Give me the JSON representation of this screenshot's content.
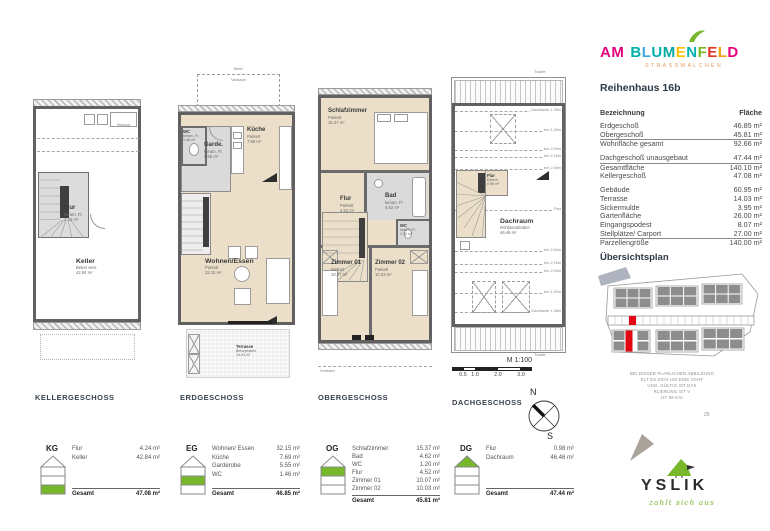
{
  "logo": {
    "letters": [
      {
        "ch": "A",
        "c": "#e5007d"
      },
      {
        "ch": "M",
        "c": "#e5007d"
      },
      {
        "ch": "B",
        "c": "#00b1af"
      },
      {
        "ch": "L",
        "c": "#3fa9dc"
      },
      {
        "ch": "U",
        "c": "#00b1af"
      },
      {
        "ch": "M",
        "c": "#00a99d"
      },
      {
        "ch": "E",
        "c": "#fdc300"
      },
      {
        "ch": "N",
        "c": "#00b1af"
      },
      {
        "ch": "F",
        "c": "#76b82a"
      },
      {
        "ch": "E",
        "c": "#e6332a"
      },
      {
        "ch": "L",
        "c": "#f59c00"
      },
      {
        "ch": "D",
        "c": "#e5007d"
      }
    ],
    "subtitle": "STRASSWALCHEN"
  },
  "title": "Reihenhaus 16b",
  "area_table": {
    "h_label": "Bezeichnung",
    "h_value": "Fläche",
    "rows": [
      {
        "l": "Erdgeschoß",
        "v": "46.85 m²"
      },
      {
        "l": "Obergeschoß",
        "v": "45.81 m²"
      },
      {
        "l": "Wohnfläche gesamt",
        "v": "92.66 m²"
      },
      {
        "l": "Dachgeschoß unausgebaut",
        "v": "47.44 m²"
      },
      {
        "l": "Gesamtfläche",
        "v": "140.10 m²"
      },
      {
        "l": "Kellergeschoß",
        "v": "47.08 m²"
      },
      {
        "l": "Gebäude",
        "v": "60.95 m²"
      },
      {
        "l": "Terrasse",
        "v": "14.03 m²"
      },
      {
        "l": "Sickermulde",
        "v": "3.95 m²"
      },
      {
        "l": "Gartenfläche",
        "v": "26.00 m²"
      },
      {
        "l": "Eingangspodest",
        "v": "8.07 m²"
      },
      {
        "l": "Stellplätze/ Carport",
        "v": "27.00 m²"
      },
      {
        "l": "Parzellengröße",
        "v": "140.00 m²"
      }
    ]
  },
  "uebersichtsplan_title": "Übersichtsplan",
  "disclaimer": {
    "lines": [
      "BEI DIESER PLANLICHEN ABBILDUNG",
      "ELT ES SICH UM EINE SCHF",
      "UNG. GÜLTIG IST DAS",
      "RLIERUNG IST V",
      "HT IM KAI"
    ],
    "page": "29"
  },
  "brand": {
    "name": "YSLIK",
    "tagline": "zahlt sich aus"
  },
  "scale": {
    "label": "M 1:100",
    "ticks": [
      "0.5",
      "1.0",
      "2.0",
      "3.0"
    ]
  },
  "compass": {
    "n": "N",
    "s": "S"
  },
  "plans": {
    "kg": {
      "caption": "KELLERGESCHOSS",
      "heizung": "Heizung",
      "flur": {
        "n": "Flur",
        "s": "keram. Fl.",
        "a": "4.24 m²"
      },
      "keller": {
        "n": "Keller",
        "s": "Beton vers.",
        "a": "42.84 m²"
      }
    },
    "eg": {
      "caption": "ERDGESCHOSS",
      "stufe": "Stufe",
      "vordach": "Vordach",
      "wc": {
        "n": "WC",
        "s": "keram. Fl.",
        "a": "1.46 m²"
      },
      "garde": {
        "n": "Garde.",
        "s": "keram. Fl.",
        "a": "5.55 m²"
      },
      "kueche": {
        "n": "Küche",
        "s": "Parkett",
        "a": "7.69 m²"
      },
      "wohnen": {
        "n": "Wohnen/Essen",
        "s": "Parkett",
        "a": "32.15 m²"
      },
      "terrasse": {
        "n": "Terrasse",
        "s": "Betonplatten",
        "a": "14.03 m²"
      }
    },
    "og": {
      "caption": "OBERGESCHOSS",
      "vordach": "Vordach",
      "schlaf": {
        "n": "Schlafzimmer",
        "s": "Parkett",
        "a": "15.37 m²"
      },
      "bad": {
        "n": "Bad",
        "s": "keram. Fl.",
        "a": "4.62 m²"
      },
      "wc": {
        "n": "WC",
        "s": "keram. Fl.",
        "a": "1.20 m²"
      },
      "flur": {
        "n": "Flur",
        "s": "Parkett",
        "a": "4.52 m²"
      },
      "z1": {
        "n": "Zimmer 01",
        "s": "Parkett",
        "a": "10.07 m²"
      },
      "z2": {
        "n": "Zimmer 02",
        "s": "Parkett",
        "a": "10.03 m²"
      }
    },
    "dg": {
      "caption": "DACHGESCHOSS",
      "traufe": "Traufe",
      "flur": {
        "n": "Flur",
        "s": "Estrich",
        "a": "0.98 m²"
      },
      "dachraum": {
        "n": "Dachraum",
        "s": "Rohbetonboden",
        "a": "46.46 m²"
      },
      "heights": [
        "Dachkante 1.36m",
        "bm 1.40m",
        "bm 2.00m",
        "bm 2.16m",
        "bm 2.60m",
        "First",
        "bm 2.60m",
        "bm 2.16m",
        "bm 2.00m",
        "bm 1.40m",
        "Dachkante 1.36m"
      ]
    }
  },
  "legends": {
    "kg": {
      "code": "KG",
      "rows": [
        {
          "n": "Flur",
          "v": "4.24 m²"
        },
        {
          "n": "Keller",
          "v": "42.84 m²"
        }
      ],
      "total_label": "Gesamt",
      "total": "47.08 m²"
    },
    "eg": {
      "code": "EG",
      "rows": [
        {
          "n": "Wohnen/ Essen",
          "v": "32.15 m²"
        },
        {
          "n": "Küche",
          "v": "7.69 m²"
        },
        {
          "n": "Garderobe",
          "v": "5.55 m²"
        },
        {
          "n": "WC",
          "v": "1.46 m²"
        }
      ],
      "total_label": "Gesamt",
      "total": "46.85 m²"
    },
    "og": {
      "code": "OG",
      "rows": [
        {
          "n": "Schlafzimmer",
          "v": "15.37 m²"
        },
        {
          "n": "Bad",
          "v": "4.62 m²"
        },
        {
          "n": "WC",
          "v": "1.20 m²"
        },
        {
          "n": "Flur",
          "v": "4.52 m²"
        },
        {
          "n": "Zimmer 01",
          "v": "10.07 m²"
        },
        {
          "n": "Zimmer 02",
          "v": "10.03 m²"
        }
      ],
      "total_label": "Gesamt",
      "total": "45.81 m²"
    },
    "dg": {
      "code": "DG",
      "rows": [
        {
          "n": "Flur",
          "v": "0.98 m²"
        },
        {
          "n": "Dachraum",
          "v": "46.46 m²"
        }
      ],
      "total_label": "Gesamt",
      "total": "47.44 m²"
    }
  },
  "colors": {
    "accent_green": "#76b82a",
    "highlight_red": "#e30613",
    "room_beige": "#ecdfc9",
    "room_grey": "#dadada",
    "wall_grey": "#616161",
    "tagline_green": "#7ab62c"
  }
}
